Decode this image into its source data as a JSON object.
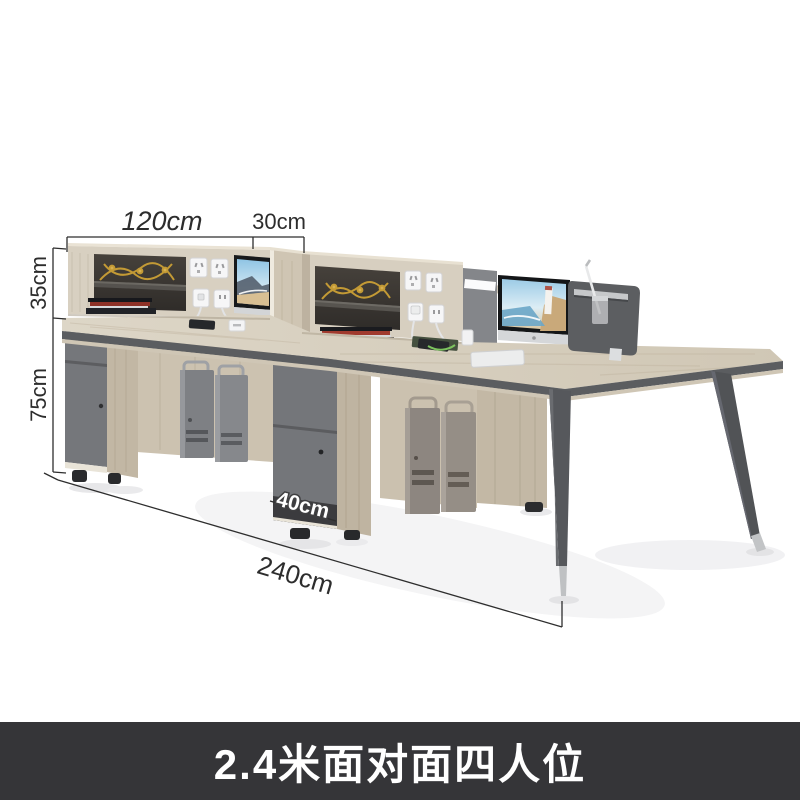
{
  "annotations": {
    "hutch_width_label": "120cm",
    "hutch_depth_label": "30cm",
    "hutch_height_label": "35cm",
    "desk_height_label": "75cm",
    "cabinet_width_label": "40cm",
    "desk_length_label": "240cm"
  },
  "caption": {
    "text": "2.4米面对面四人位"
  },
  "colors": {
    "background": "#ffffff",
    "caption_bar": "#353538",
    "caption_text": "#ffffff",
    "dimension_line": "#2e2e2e",
    "wood_front": "#d8d0c1",
    "wood_top": "#d6cdbc",
    "wood_side": "#c2b7a4",
    "hutch_interior": "#3d3935",
    "cabinet_gray": "#75777b",
    "desk_edge_band": "#5b5d60",
    "divider_end": "#5c5e61",
    "divider_mid": "#84868a",
    "ornament_gold": "#c39a35",
    "leg_gray": "#55575a",
    "leg_tip_silver": "#c0c2c4",
    "monitor_bezel": "#17191b",
    "screen_sky": "#8fc4e4",
    "screen_sand": "#d8bf93"
  }
}
